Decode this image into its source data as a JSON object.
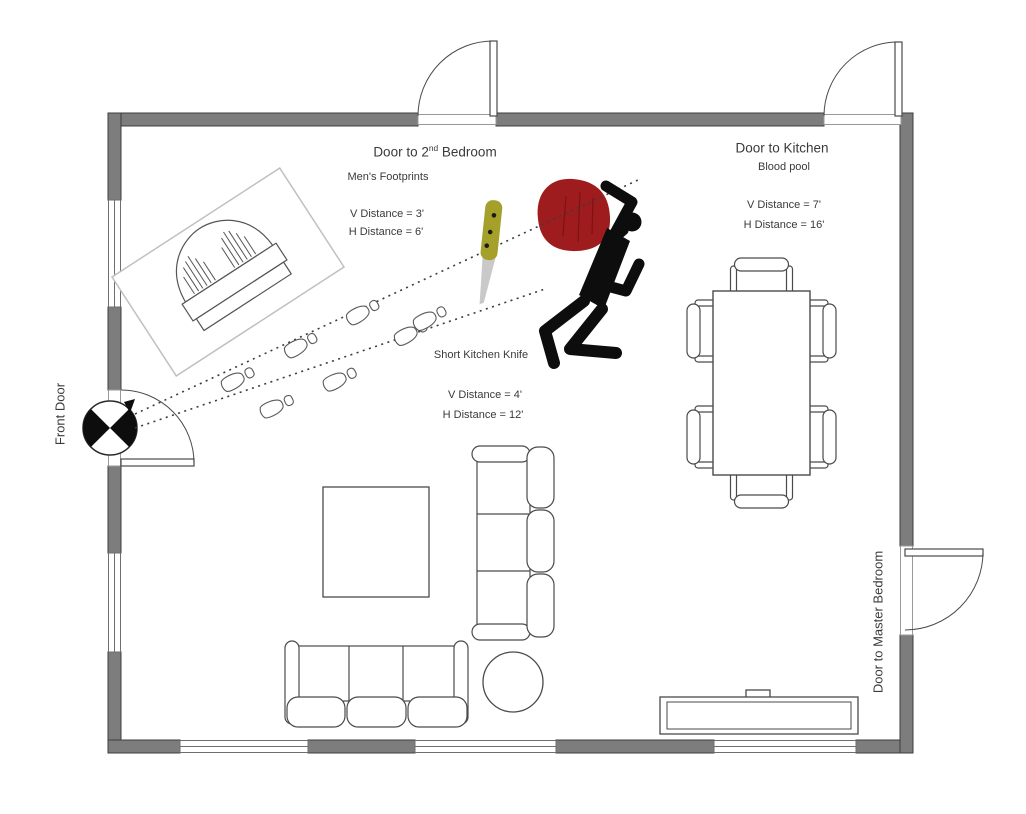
{
  "labels": {
    "bedroom2_door_pre": "Door to 2",
    "bedroom2_door_sup": "nd",
    "bedroom2_door_post": " Bedroom",
    "mens_footprints": "Men's Footprints",
    "footprints_v": "V Distance = 3'",
    "footprints_h": "H Distance = 6'",
    "kitchen_door": "Door to Kitchen",
    "blood_pool": "Blood pool",
    "blood_v": "V Distance = 7'",
    "blood_h": "H Distance = 16'",
    "knife": "Short Kitchen Knife",
    "knife_v": "V Distance = 4'",
    "knife_h": "H Distance = 12'",
    "front_door": "Front Door",
    "master_door": "Door to Master Bedroom"
  },
  "colors": {
    "wall": "#7d7d7d",
    "blood": "#9e1c1e",
    "knife_handle": "#a5a02a",
    "knife_blade": "#c9c9c9",
    "body": "#0d0d0d",
    "label_text": "#3a3a3a"
  },
  "objects": [
    "front-door-position-marker",
    "mens-footprints-trail",
    "trajectory-dotted-lines",
    "short-kitchen-knife",
    "blood-pool",
    "victim-body-silhouette",
    "overturned-piano",
    "dining-table-with-six-chairs",
    "coffee-table",
    "large-sofa",
    "small-sofa",
    "round-side-table",
    "tv-console"
  ]
}
